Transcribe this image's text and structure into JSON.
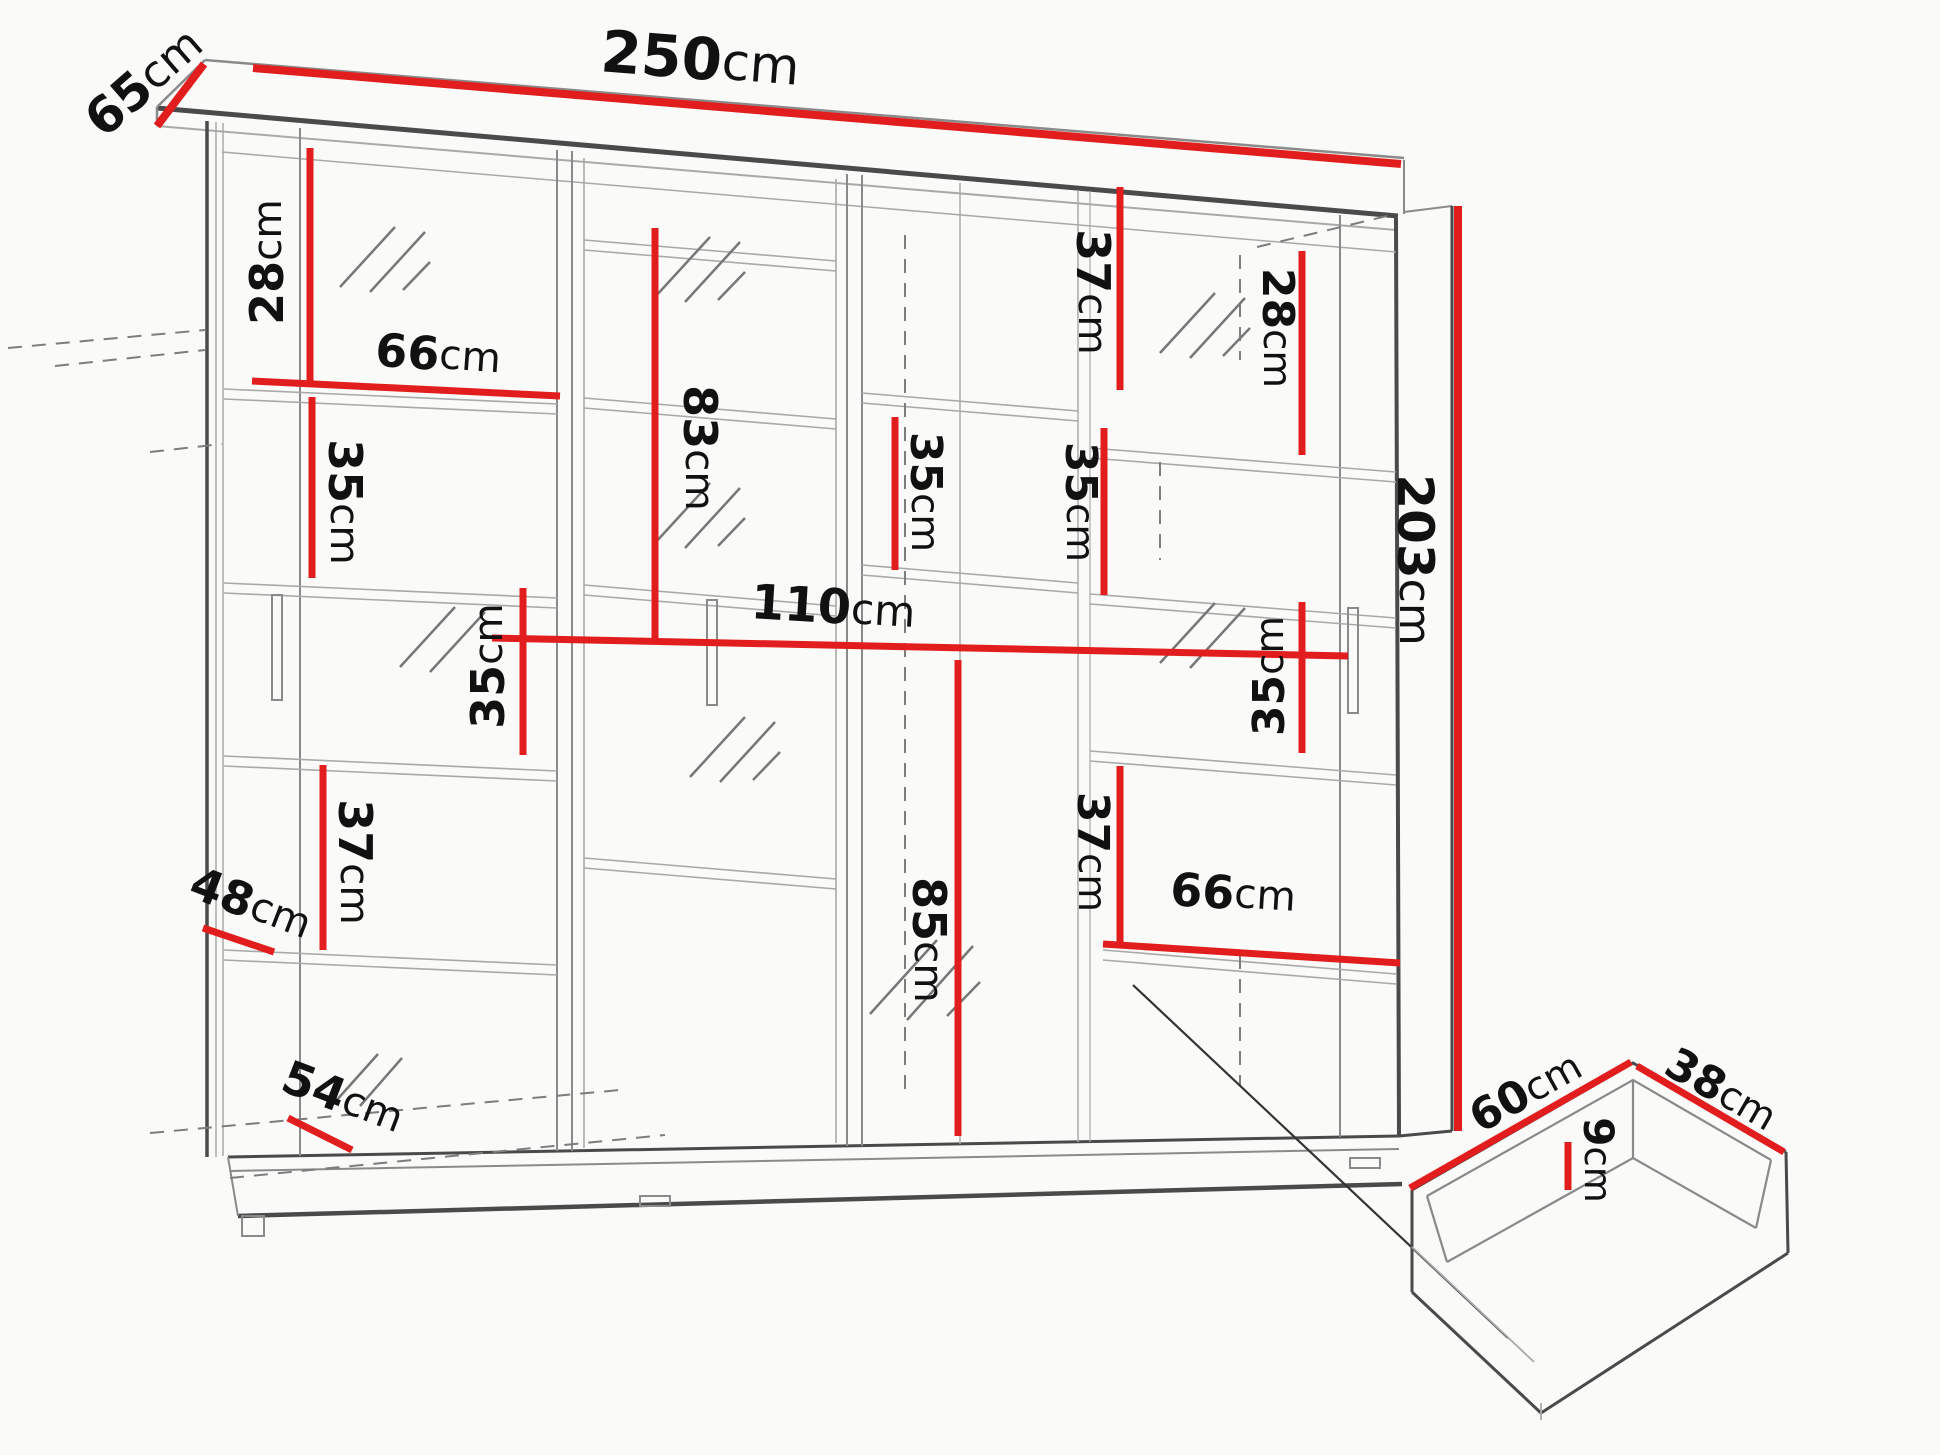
{
  "title": "Wardrobe with sliding doors - dimension diagram",
  "unit": "cm",
  "colors": {
    "dimension_line": "#e21d1d",
    "structure_line": "#4a4a4a",
    "background": "#fafaf8"
  },
  "dims": {
    "width_250": {
      "num": "250",
      "unit": "cm"
    },
    "depth_65": {
      "num": "65",
      "unit": "cm"
    },
    "height_203": {
      "num": "203",
      "unit": "cm"
    },
    "left_top_28": {
      "num": "28",
      "unit": "cm"
    },
    "left_shelf_66": {
      "num": "66",
      "unit": "cm"
    },
    "left_35_a": {
      "num": "35",
      "unit": "cm"
    },
    "left_35_b": {
      "num": "35",
      "unit": "cm"
    },
    "center_83": {
      "num": "83",
      "unit": "cm"
    },
    "center_110": {
      "num": "110",
      "unit": "cm"
    },
    "center_85": {
      "num": "85",
      "unit": "cm"
    },
    "left_37": {
      "num": "37",
      "unit": "cm"
    },
    "depth_48": {
      "num": "48",
      "unit": "cm"
    },
    "plinth_54": {
      "num": "54",
      "unit": "cm"
    },
    "right_37_top": {
      "num": "37",
      "unit": "cm"
    },
    "mid_35": {
      "num": "35",
      "unit": "cm"
    },
    "right_28": {
      "num": "28",
      "unit": "cm"
    },
    "right_35_a": {
      "num": "35",
      "unit": "cm"
    },
    "right_35_b": {
      "num": "35",
      "unit": "cm"
    },
    "right_37_bottom": {
      "num": "37",
      "unit": "cm"
    },
    "right_shelf_66": {
      "num": "66",
      "unit": "cm"
    },
    "drawer_60": {
      "num": "60",
      "unit": "cm"
    },
    "drawer_38": {
      "num": "38",
      "unit": "cm"
    },
    "drawer_9": {
      "num": "9",
      "unit": "cm"
    }
  }
}
